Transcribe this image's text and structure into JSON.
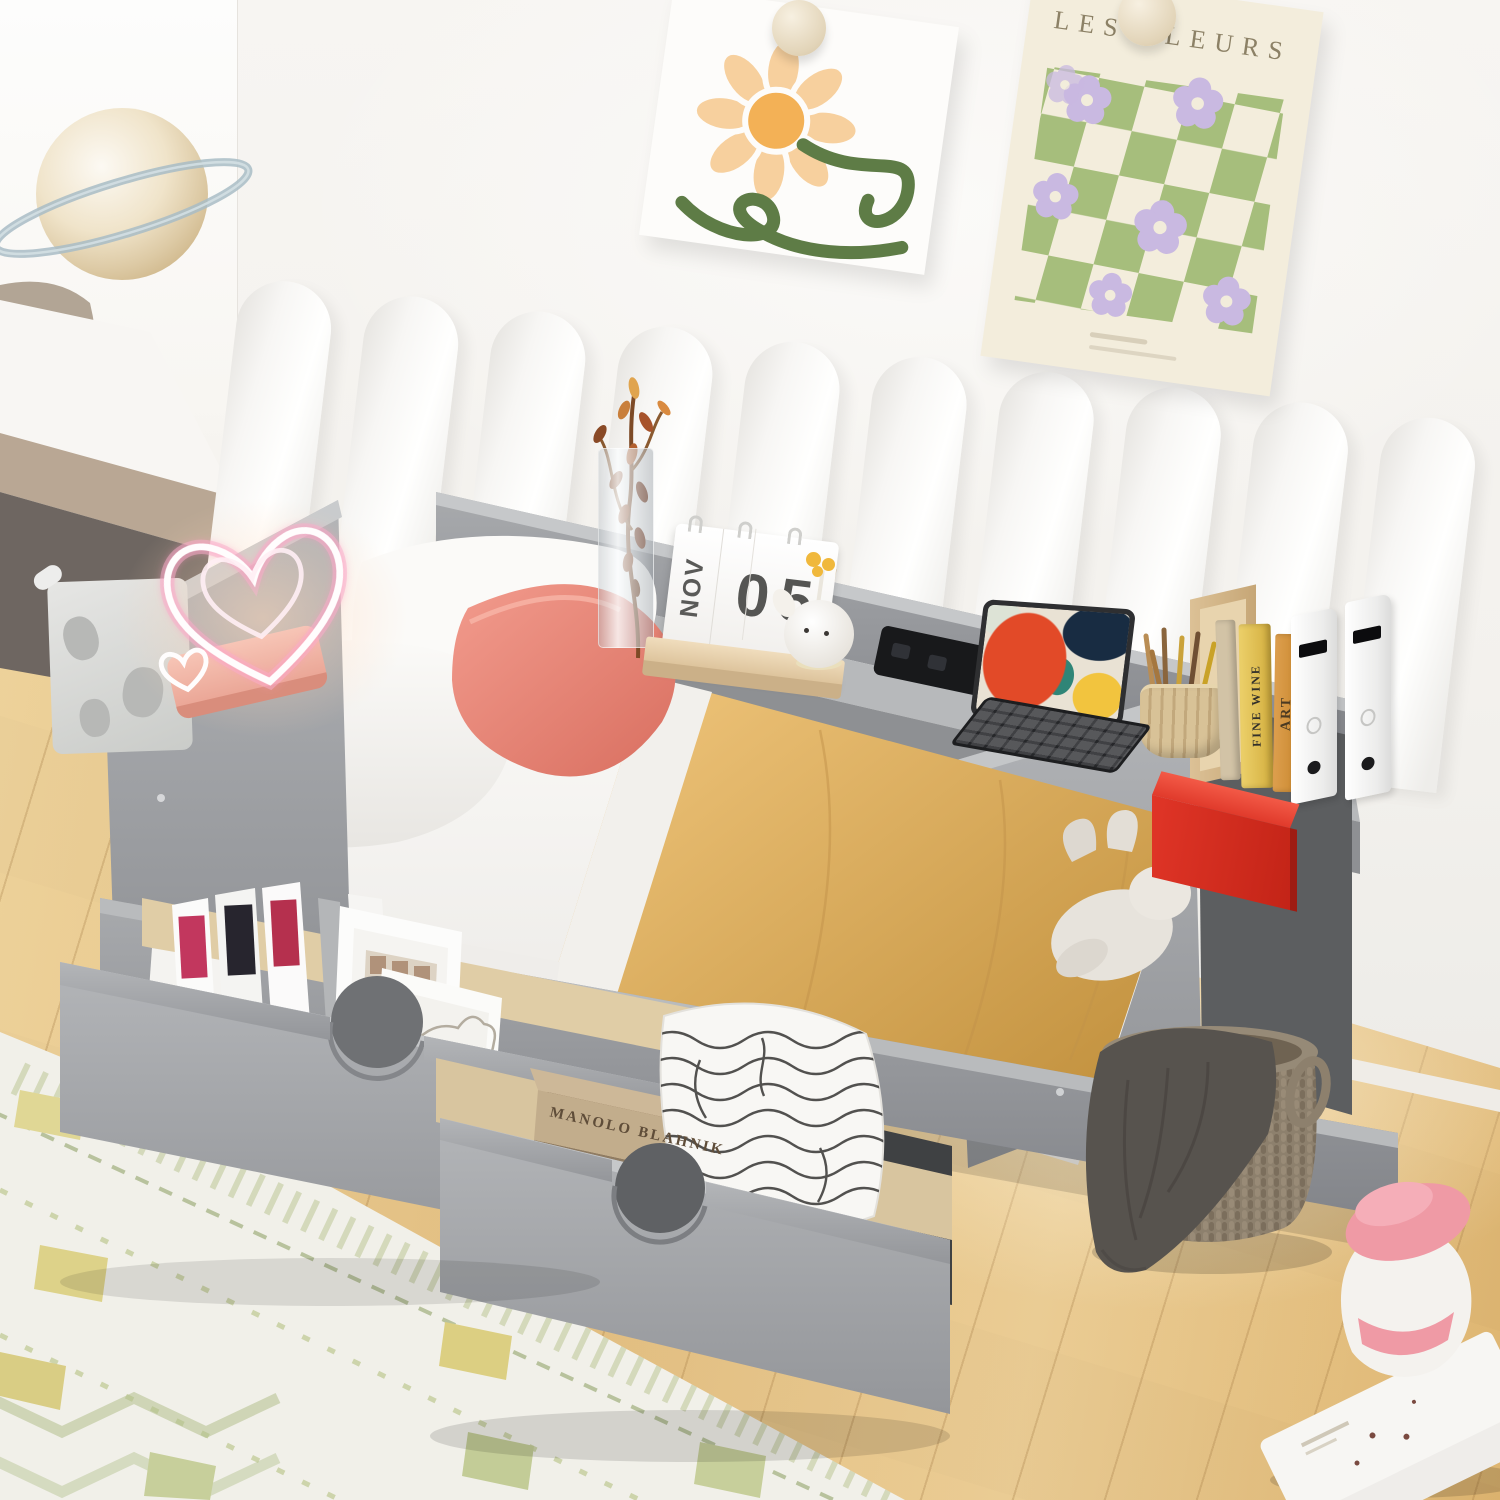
{
  "posters": {
    "les_fleurs_title": "LES FLEURS"
  },
  "calendar": {
    "month": "NOV",
    "day": "05"
  },
  "books": {
    "shelf_book_1": "FINE WINE",
    "shelf_book_2": "ART",
    "drawer_book": "MANOLO BLAHNIK"
  },
  "colors": {
    "bed_frame_gray": "#9b9da0",
    "blanket_tan": "#dcb166",
    "accent_pillow_coral": "#ec8b7e",
    "red_box": "#d63125",
    "wall_white": "#f5f3f0",
    "floor_wood": "#e9c88c",
    "rug_cream": "#f1f0e9",
    "poster_check_green": "#a6be7c",
    "poster_flower_purple": "#c9b9e1",
    "lamp_pink": "#f2b3a6",
    "tablet_art_orange": "#e24a28",
    "basket_brown": "#8d806d"
  }
}
